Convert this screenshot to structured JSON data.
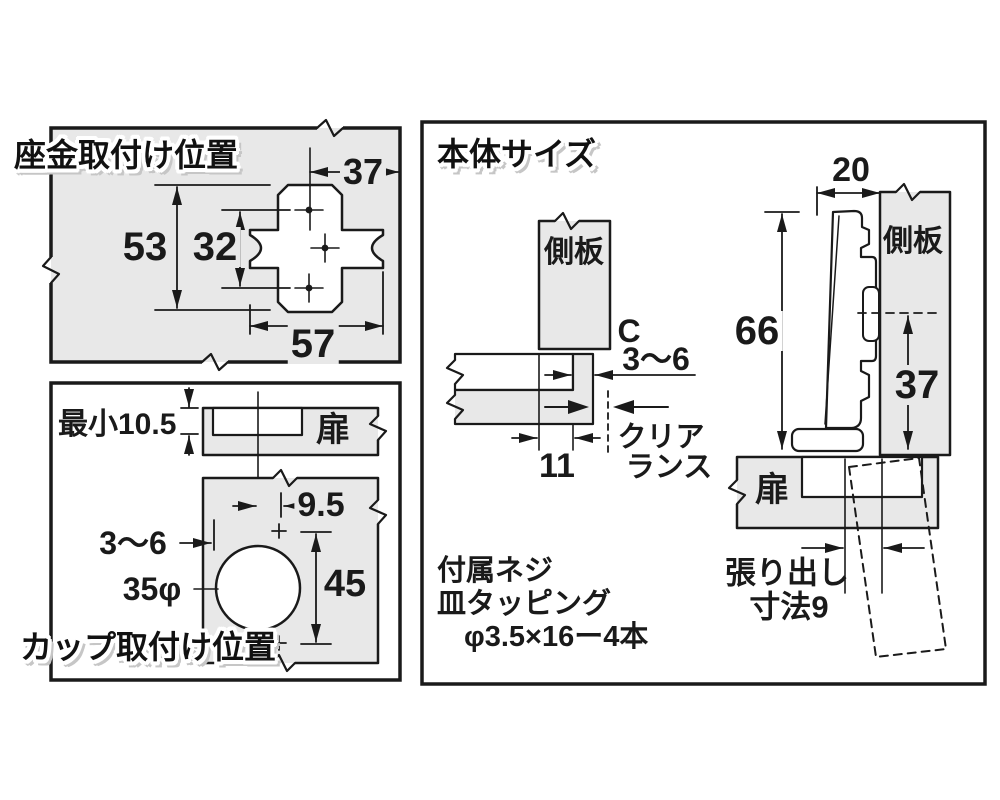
{
  "colors": {
    "panel_gray": "#e8e8e8",
    "line": "#1a1a1a",
    "title_shadow": "#c6c6c6",
    "white": "#ffffff"
  },
  "plate_panel": {
    "title": "座金取付け位置",
    "dim_top": "37",
    "dim_height_outer": "53",
    "dim_height_holes": "32",
    "dim_width": "57"
  },
  "cup_panel": {
    "title": "カップ取付け位置",
    "min_edge_distance": "最小10.5",
    "door_label": "扉",
    "dim_center_offset": "9.5",
    "dim_edge_range": "3〜6",
    "cup_diameter": "35φ",
    "dim_hole_pitch": "45"
  },
  "body_panel": {
    "title": "本体サイズ",
    "side_panel_label": "側板",
    "c_label": "C",
    "c_range": "3〜6",
    "dim_overlay": "11",
    "clearance_line1": "クリア",
    "clearance_line2": "ランス",
    "dim_depth": "20",
    "dim_total_height": "66",
    "dim_plate_offset": "37",
    "side_panel_label2": "側板",
    "door_label": "扉",
    "overhang_line1": "張り出し",
    "overhang_line2": "寸法9",
    "screw_note_line1": "付属ネジ",
    "screw_note_line2": "皿タッピング",
    "screw_note_line3": "φ3.5×16ー4本"
  }
}
